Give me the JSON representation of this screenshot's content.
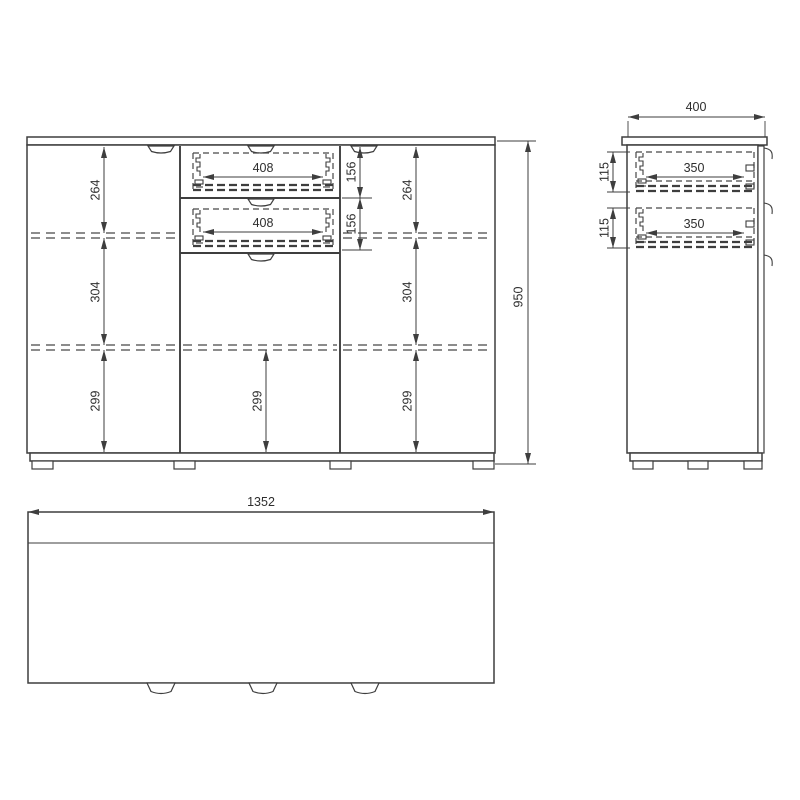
{
  "drawing": {
    "front_view": {
      "left_heights": [
        "264",
        "304",
        "299"
      ],
      "right_heights": [
        "264",
        "304",
        "299"
      ],
      "center_bottom_height": "299",
      "drawer_widths": [
        "408",
        "408"
      ],
      "drawer_front_heights": [
        "156",
        "156"
      ],
      "overall_height": "950"
    },
    "side_view": {
      "depth": "400",
      "drawer_depths": [
        "350",
        "350"
      ],
      "drawer_heights": [
        "115",
        "115"
      ]
    },
    "top_view": {
      "overall_width": "1352"
    },
    "colors": {
      "line": "#3e3e3e",
      "background": "#ffffff"
    }
  }
}
